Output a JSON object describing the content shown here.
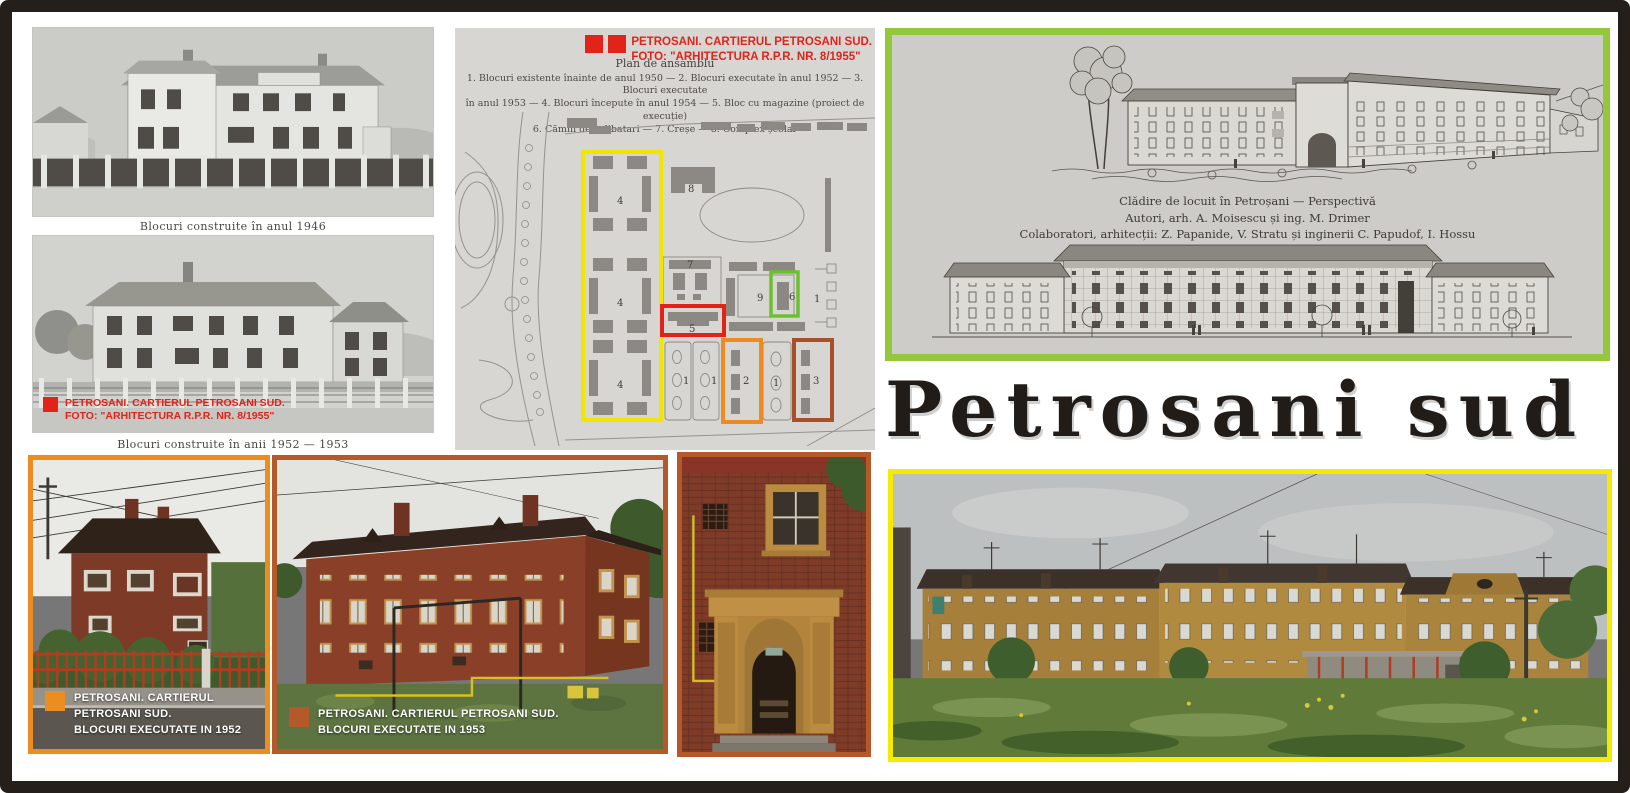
{
  "frame": {
    "border_color": "#241f1b",
    "background": "#ffffff"
  },
  "title": {
    "text": "Petrosani sud",
    "color": "#211c18"
  },
  "archive_panel": {
    "caption_1946": "Blocuri construite în anul 1946",
    "caption_1952_1953": "Blocuri construite în anii 1952 — 1953",
    "credit": {
      "line1": "PETROSANI. CARTIERUL PETROSANI SUD.",
      "line2": "FOTO: \"ARHITECTURA R.P.R. NR. 8/1955\"",
      "color": "#e2231a"
    }
  },
  "plan_panel": {
    "credit": {
      "line1": "PETROSANI. CARTIERUL PETROSANI SUD.",
      "line2": "FOTO: \"ARHITECTURA R.P.R. NR. 8/1955\""
    },
    "legend_title": "Plan de ansamblu",
    "legend_lines": [
      "1. Blocuri existente înainte de anul 1950 — 2. Blocuri executate în anul 1952 — 3. Blocuri executate",
      "în anul 1953 — 4. Blocuri începute în anul 1954 — 5. Bloc cu magazine (proiect de execuție)",
      "6. Cămin de celibatari — 7. Creșe — 8. Complex școlar"
    ],
    "markers": {
      "cluster4_top": "4",
      "cluster4_mid": "4",
      "cluster4_bottom": "4",
      "school8": "8",
      "creche7": "7",
      "block9": "9",
      "dorm6": "6",
      "shops5": "5",
      "lot1_a": "1",
      "lot1_b": "1",
      "lot1_c": "1",
      "col1": "1",
      "blocks2": "2",
      "blocks3": "3"
    },
    "highlight_colors": {
      "existing_yellow": "#f2e600",
      "shops_red": "#e02316",
      "dorm_green": "#6cc02f",
      "built1952_orange": "#ee8b20",
      "built1953_brown": "#a8502a"
    }
  },
  "drawing_panel": {
    "border_color": "#94c83c",
    "caption_lines": [
      "Clădire de locuit în Petroșani — Perspectivă",
      "Autori, arh. A. Moisescu și ing. M. Drimer",
      "Colaboratori, arhitecții: Z. Papanide, V. Stratu și inginerii C. Papudof, I. Hossu"
    ]
  },
  "photo_1952": {
    "border_color": "#ec8d21",
    "label_line1": "PETROSANI. CARTIERUL PETROSANI SUD.",
    "label_line2": "BLOCURI EXECUTATE IN 1952"
  },
  "photo_1953": {
    "border_color": "#b5592b",
    "label_line1": "PETROSANI. CARTIERUL PETROSANI SUD.",
    "label_line2": "BLOCURI EXECUTATE IN 1953"
  },
  "photo_entrance": {
    "border_color": "#b5592b"
  },
  "photo_modern_wide": {
    "border_color": "#f6ea00"
  }
}
